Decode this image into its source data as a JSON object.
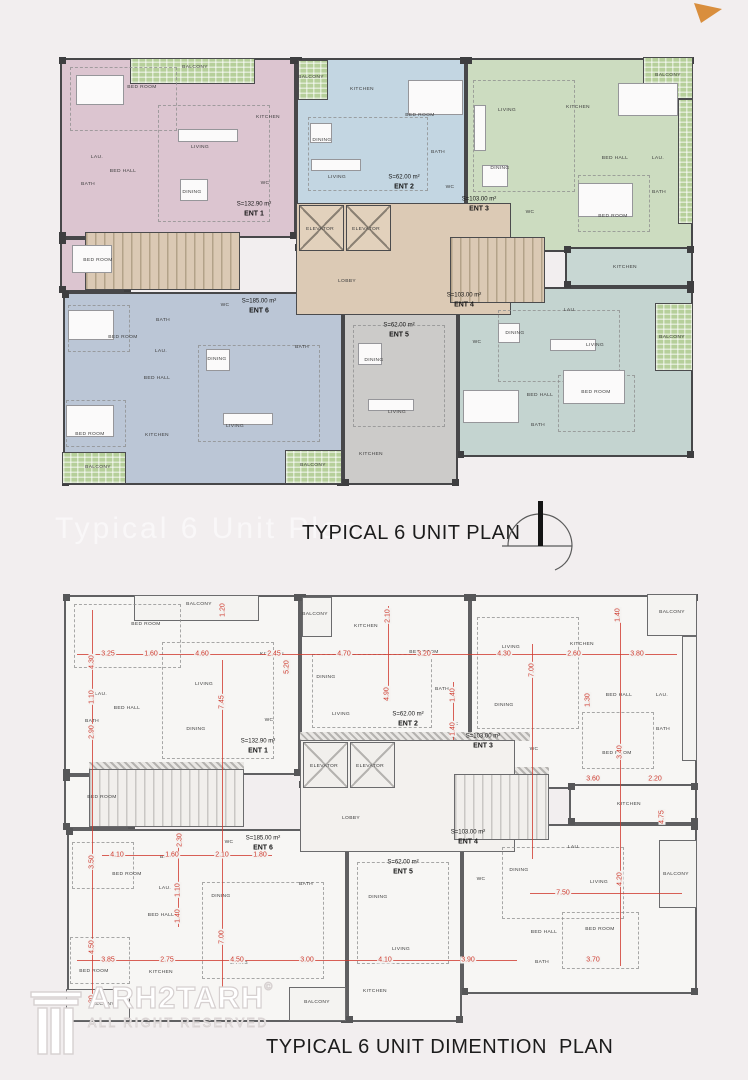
{
  "titles": {
    "plan": "TYPICAL 6 UNIT PLAN",
    "dimension": "TYPICAL 6 UNIT DIMENTION  PLAN",
    "watermark": "Typical 6 Unit Plan"
  },
  "logo": {
    "text": "ARH2TARH",
    "copyright": "©",
    "sub": "ALL RIGHT RESERVED"
  },
  "colors": {
    "page_bg": "#f2eeef",
    "wall": "#474749",
    "dim_red": "#cf3a2e",
    "core_tan": "#dccab5",
    "balcony_green": "#b6cf9a",
    "unit1_pink": "#dcc5d0",
    "unit2_blue": "#c3d6e2",
    "unit3_green": "#ccdcc0",
    "unit4_teal": "#c4d4d0",
    "unit5_gray": "#cccbc9",
    "unit6_slate": "#bbc6d6"
  },
  "plan": {
    "units": [
      {
        "n": "unit-1",
        "c": "#dcc5d0",
        "r": [
          2,
          3,
          236,
          180
        ]
      },
      {
        "n": "unit-1-wing",
        "c": "#dcc5d0",
        "r": [
          2,
          183,
          70,
          54
        ]
      },
      {
        "n": "unit-2",
        "c": "#c3d6e2",
        "r": [
          238,
          3,
          170,
          192
        ]
      },
      {
        "n": "unit-3",
        "c": "#ccdcc0",
        "r": [
          408,
          3,
          227,
          194
        ]
      },
      {
        "n": "unit-4",
        "c": "#c4d4d0",
        "r": [
          400,
          232,
          235,
          170
        ]
      },
      {
        "n": "unit-4-kitchen-strip",
        "c": "#c8d7d3",
        "r": [
          507,
          192,
          128,
          40
        ]
      },
      {
        "n": "unit-5",
        "c": "#cccbc9",
        "r": [
          285,
          247,
          115,
          183
        ]
      },
      {
        "n": "unit-6",
        "c": "#bbc6d6",
        "r": [
          5,
          237,
          280,
          193
        ]
      }
    ],
    "core": {
      "lobby": [
        238,
        148,
        215,
        112
      ],
      "elevators": [
        [
          241,
          150,
          45,
          46
        ],
        [
          288,
          150,
          45,
          46
        ]
      ],
      "stairs": [
        [
          27,
          177,
          155,
          58
        ],
        [
          392,
          182,
          95,
          66
        ]
      ]
    },
    "balconies": [
      [
        72,
        3,
        125,
        26
      ],
      [
        240,
        5,
        30,
        40
      ],
      [
        585,
        2,
        50,
        42
      ],
      [
        620,
        44,
        15,
        125
      ],
      [
        597,
        248,
        38,
        68
      ],
      [
        4,
        397,
        64,
        32
      ],
      [
        227,
        395,
        57,
        34
      ]
    ],
    "zones": [
      [
        100,
        50,
        110,
        115
      ],
      [
        12,
        12,
        105,
        62
      ],
      [
        250,
        62,
        118,
        72
      ],
      [
        415,
        25,
        100,
        110
      ],
      [
        520,
        120,
        70,
        55
      ],
      [
        440,
        255,
        120,
        70
      ],
      [
        500,
        320,
        75,
        55
      ],
      [
        295,
        270,
        90,
        100
      ],
      [
        10,
        250,
        60,
        45
      ],
      [
        8,
        345,
        58,
        45
      ],
      [
        140,
        290,
        120,
        95
      ]
    ],
    "furniture": [
      [
        18,
        20,
        48,
        30
      ],
      [
        14,
        190,
        40,
        28
      ],
      [
        350,
        25,
        55,
        35
      ],
      [
        560,
        28,
        60,
        33
      ],
      [
        520,
        128,
        55,
        34
      ],
      [
        505,
        315,
        62,
        34
      ],
      [
        405,
        335,
        56,
        33
      ],
      [
        10,
        255,
        46,
        30
      ],
      [
        8,
        350,
        48,
        32
      ],
      [
        120,
        74,
        60,
        13
      ],
      [
        122,
        124,
        28,
        22
      ],
      [
        253,
        104,
        50,
        12
      ],
      [
        252,
        68,
        22,
        20
      ],
      [
        416,
        50,
        12,
        46
      ],
      [
        424,
        110,
        26,
        22
      ],
      [
        492,
        284,
        46,
        12
      ],
      [
        440,
        268,
        22,
        20
      ],
      [
        300,
        288,
        24,
        22
      ],
      [
        310,
        344,
        46,
        12
      ],
      [
        165,
        358,
        50,
        12
      ],
      [
        148,
        294,
        24,
        22
      ]
    ],
    "labels": [
      [
        "BALCONY",
        137,
        12
      ],
      [
        "BED ROOM",
        84,
        32
      ],
      [
        "KITCHEN",
        210,
        62
      ],
      [
        "LIVING",
        142,
        92
      ],
      [
        "DINING",
        134,
        137
      ],
      [
        "BED HALL",
        65,
        116
      ],
      [
        "LAU.",
        39,
        102
      ],
      [
        "BATH",
        30,
        129
      ],
      [
        "WC",
        207,
        128
      ],
      [
        "BED ROOM",
        40,
        205
      ],
      [
        "BALCONY",
        253,
        22
      ],
      [
        "KITCHEN",
        304,
        34
      ],
      [
        "DINING",
        264,
        85
      ],
      [
        "LIVING",
        279,
        122
      ],
      [
        "BED ROOM",
        362,
        60
      ],
      [
        "BATH",
        380,
        97
      ],
      [
        "WC",
        392,
        132
      ],
      [
        "BALCONY",
        610,
        20
      ],
      [
        "KITCHEN",
        520,
        52
      ],
      [
        "LIVING",
        449,
        55
      ],
      [
        "DINING",
        442,
        113
      ],
      [
        "BED HALL",
        557,
        103
      ],
      [
        "LAU.",
        600,
        103
      ],
      [
        "BED ROOM",
        555,
        161
      ],
      [
        "BATH",
        601,
        137
      ],
      [
        "WC",
        472,
        157
      ],
      [
        "KITCHEN",
        567,
        212
      ],
      [
        "LAU.",
        512,
        255
      ],
      [
        "DINING",
        457,
        278
      ],
      [
        "LIVING",
        537,
        290
      ],
      [
        "BED HALL",
        482,
        340
      ],
      [
        "BED ROOM",
        538,
        337
      ],
      [
        "BATH",
        480,
        370
      ],
      [
        "WC",
        419,
        287
      ],
      [
        "BALCONY",
        614,
        282
      ],
      [
        "BATH",
        244,
        292
      ],
      [
        "DINING",
        316,
        305
      ],
      [
        "LIVING",
        339,
        357
      ],
      [
        "KITCHEN",
        313,
        399
      ],
      [
        "BALCONY",
        255,
        410
      ],
      [
        "WC",
        167,
        250
      ],
      [
        "BATH",
        105,
        265
      ],
      [
        "LAU.",
        103,
        296
      ],
      [
        "BED HALL",
        99,
        323
      ],
      [
        "BED ROOM",
        65,
        282
      ],
      [
        "DINING",
        159,
        304
      ],
      [
        "LIVING",
        177,
        371
      ],
      [
        "KITCHEN",
        99,
        380
      ],
      [
        "BED ROOM",
        32,
        379
      ],
      [
        "BALCONY",
        40,
        412
      ],
      [
        "ELEVATOR",
        262,
        174
      ],
      [
        "ELEVATOR",
        308,
        174
      ],
      [
        "LOBBY",
        289,
        226
      ]
    ],
    "ents": [
      [
        "S=132.90 m²",
        "ENT 1",
        196,
        155
      ],
      [
        "S=62.00 m²",
        "ENT 2",
        346,
        128
      ],
      [
        "S=103.00 m²",
        "ENT 3",
        421,
        150
      ],
      [
        "S=103.00 m²",
        "ENT 4",
        406,
        246
      ],
      [
        "S=62.00 m²",
        "ENT 5",
        341,
        276
      ],
      [
        "S=185.00 m²",
        "ENT 6",
        201,
        252
      ]
    ],
    "dims": {
      "hlines": [
        [
          15,
          62,
          600
        ],
        [
          15,
          368,
          440
        ],
        [
          468,
          301,
          152
        ],
        [
          40,
          263,
          170
        ]
      ],
      "vlines": [
        [
          30,
          18,
          398
        ],
        [
          160,
          68,
          348
        ],
        [
          326,
          14,
          92
        ],
        [
          391,
          90,
          58
        ],
        [
          470,
          52,
          215
        ],
        [
          558,
          16,
          358
        ],
        [
          116,
          240,
          95
        ]
      ],
      "h": [
        [
          "3.25",
          46,
          62
        ],
        [
          "1.60",
          89,
          62
        ],
        [
          "4.60",
          140,
          62
        ],
        [
          "2.45",
          212,
          62
        ],
        [
          "4.70",
          282,
          62
        ],
        [
          "3.20",
          362,
          62
        ],
        [
          "4.30",
          442,
          62
        ],
        [
          "2.60",
          512,
          62
        ],
        [
          "3.80",
          575,
          62
        ],
        [
          "3.85",
          46,
          368
        ],
        [
          "2.75",
          105,
          368
        ],
        [
          "4.50",
          175,
          368
        ],
        [
          "3.00",
          245,
          368
        ],
        [
          "4.10",
          323,
          368
        ],
        [
          "3.90",
          406,
          368
        ],
        [
          "7.50",
          501,
          301
        ],
        [
          "3.60",
          531,
          187
        ],
        [
          "2.20",
          593,
          187
        ],
        [
          "3.70",
          531,
          368
        ],
        [
          "4.10",
          55,
          263
        ],
        [
          "1.60",
          110,
          263
        ],
        [
          "2.10",
          160,
          263
        ],
        [
          "1.80",
          198,
          263
        ]
      ],
      "v": [
        [
          "4.30",
          30,
          70
        ],
        [
          "1.10",
          30,
          105
        ],
        [
          "2.90",
          30,
          140
        ],
        [
          "3.50",
          30,
          270
        ],
        [
          "4.50",
          30,
          355
        ],
        [
          "1.30",
          30,
          410
        ],
        [
          "7.45",
          160,
          110
        ],
        [
          "7.00",
          160,
          345
        ],
        [
          "5.20",
          225,
          75
        ],
        [
          "4.90",
          325,
          102
        ],
        [
          "2.10",
          326,
          24
        ],
        [
          "1.40",
          391,
          103
        ],
        [
          "1.40",
          391,
          137
        ],
        [
          "7.00",
          470,
          78
        ],
        [
          "1.30",
          526,
          108
        ],
        [
          "3.40",
          558,
          160
        ],
        [
          "4.20",
          558,
          287
        ],
        [
          "1.20",
          161,
          18
        ],
        [
          "1.40",
          556,
          23
        ],
        [
          "2.30",
          118,
          248
        ],
        [
          "1.10",
          116,
          298
        ],
        [
          "1.40",
          116,
          324
        ],
        [
          "4.75",
          600,
          225
        ]
      ]
    }
  }
}
